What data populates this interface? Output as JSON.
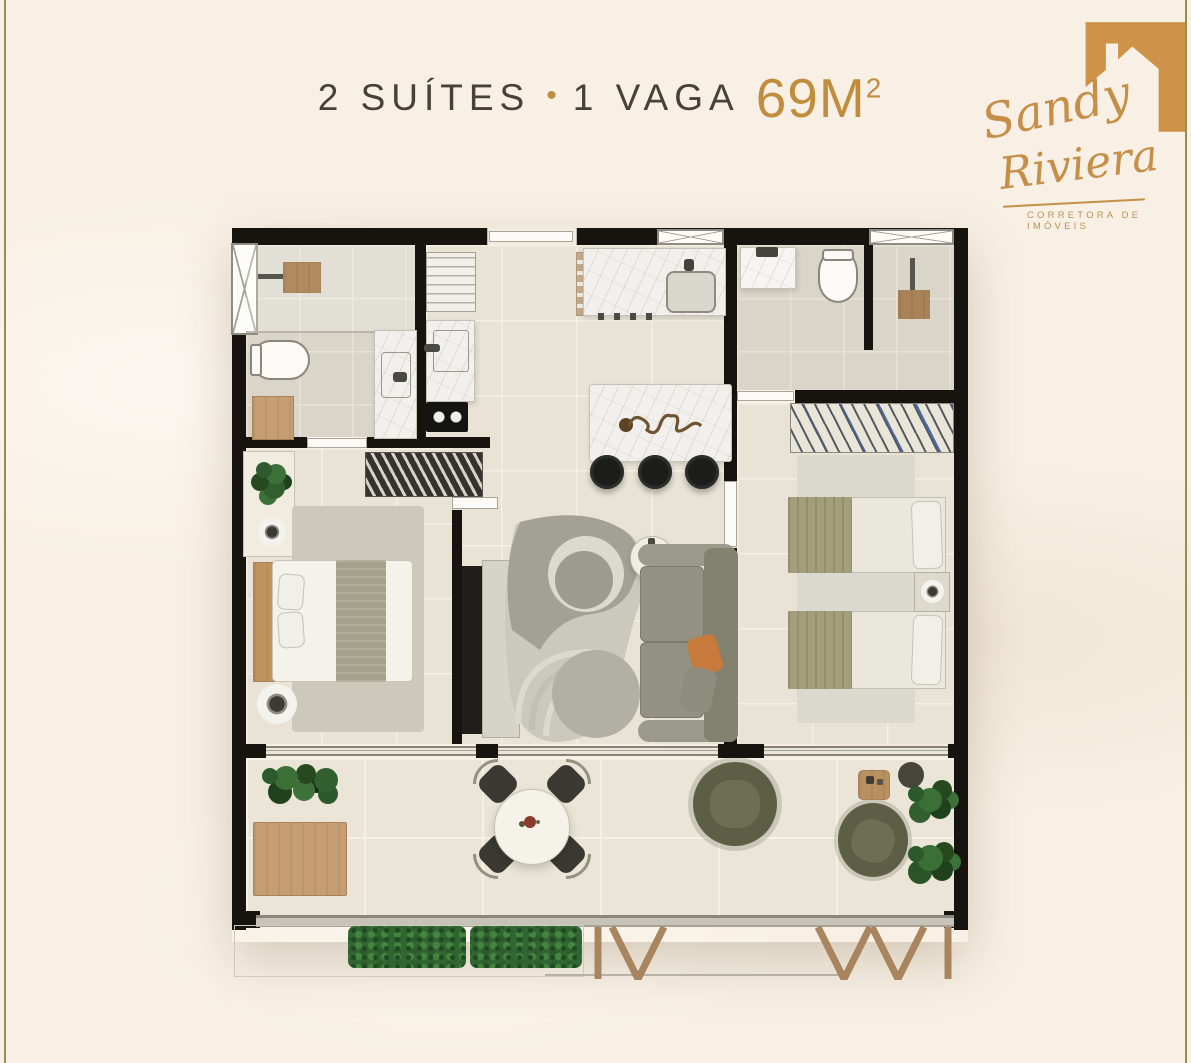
{
  "page": {
    "background_color": "#f8f0e4",
    "edge_line_color": "#90914b"
  },
  "header": {
    "suites_label": "2 SUÍTES",
    "separator": "•",
    "vaga_label": "1 VAGA",
    "area_value": "69M",
    "area_superscript": "2",
    "text_color": "#46413a",
    "accent_color": "#c08d3e"
  },
  "logo": {
    "brand_line1": "Sandy",
    "brand_line2": "Riviera",
    "tagline": "CORRETORA DE IMÓVEIS",
    "brand_color": "#c68f49",
    "icon": "house-icon"
  },
  "plan": {
    "wall_color": "#17130e",
    "rooms": [
      "suite-1-bathroom",
      "laundry-kitchen-strip",
      "kitchen",
      "suite-2-bathroom",
      "suite-1",
      "living-room",
      "suite-2",
      "balcony"
    ]
  }
}
